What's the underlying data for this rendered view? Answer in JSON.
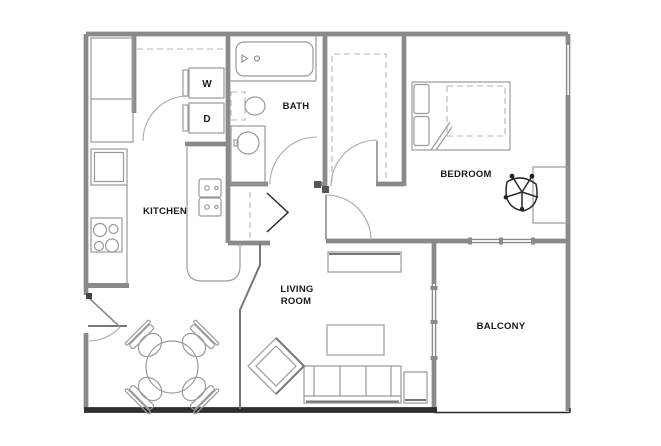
{
  "figure": "apartment-floor-plan",
  "rooms": {
    "kitchen": "KITCHEN",
    "bath": "BATH",
    "bedroom": "BEDROOM",
    "living_line1": "LIVING",
    "living_line2": "ROOM",
    "balcony": "BALCONY"
  },
  "appliances": {
    "washer": "W",
    "dryer": "D"
  },
  "colors": {
    "background": "#ffffff",
    "wall": "#8a8a8a",
    "wall_dark": "#2f2f2f",
    "fixture": "#9a9a9a",
    "text": "#1a1a1a"
  }
}
